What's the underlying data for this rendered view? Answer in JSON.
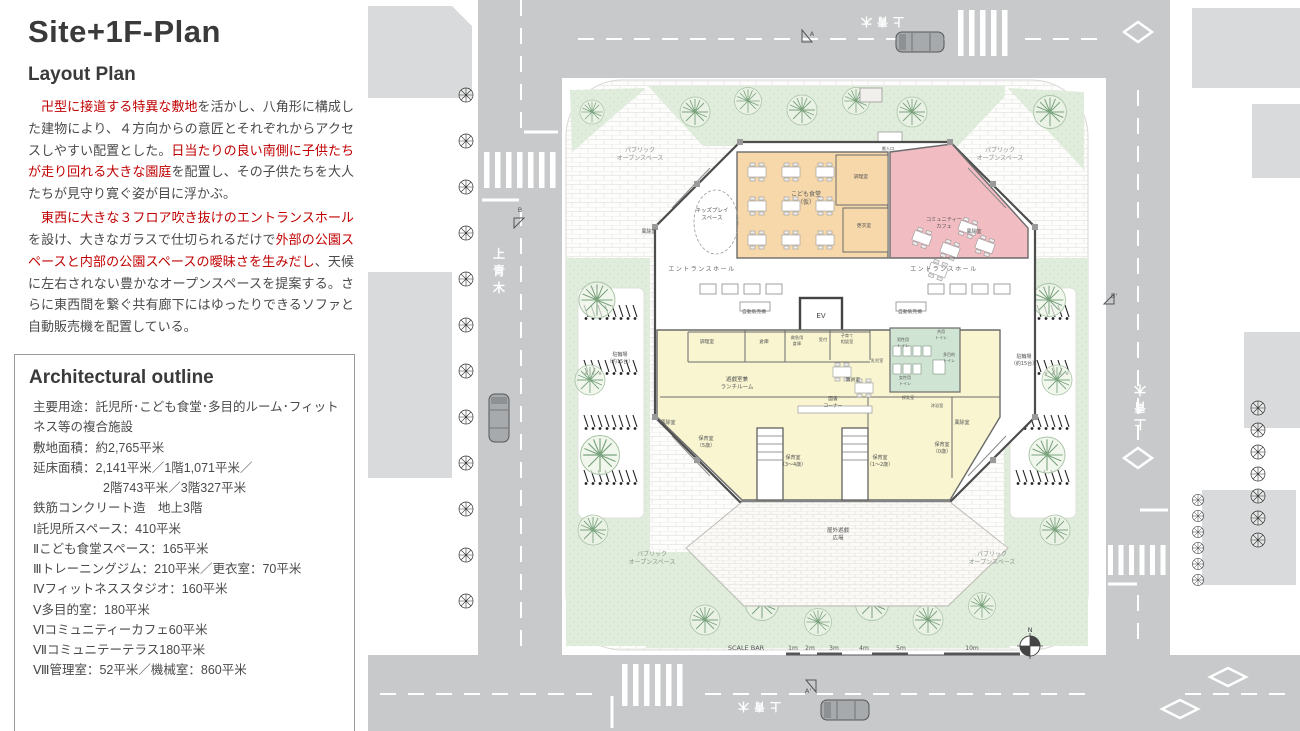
{
  "left_panel": {
    "title": "Site+1F-Plan",
    "subtitle": "Layout Plan",
    "paragraphs": [
      {
        "segments": [
          {
            "text": "　卍型に接道する特異な敷地",
            "red": true
          },
          {
            "text": "を活かし、八角形に構成した建物により、４方向からの意匠とそれぞれからアクセスしやすい配置とした。",
            "red": false
          },
          {
            "text": "日当たりの良い南側に子供たちが走り回れる大きな園庭",
            "red": true
          },
          {
            "text": "を配置し、その子供たちを大人たちが見守り寛ぐ姿が目に浮かぶ。",
            "red": false
          }
        ]
      },
      {
        "segments": [
          {
            "text": "　東西に大きな３フロア吹き抜けのエントランスホール",
            "red": true
          },
          {
            "text": "を設け、大きなガラスで仕切られるだけで",
            "red": false
          },
          {
            "text": "外部の公園スペースと内部の公園スペースの曖昧さを生みだし",
            "red": true
          },
          {
            "text": "、天候に左右されない豊かなオープンスペースを提案する。さらに東西間を繋ぐ共有廊下にはゆったりできるソファと自動販売機を配置している。",
            "red": false
          }
        ]
      }
    ],
    "outline": {
      "title": "Architectural outline",
      "lines": [
        {
          "text": "主要用途：託児所･こども食堂･多目的ルーム･フィットネス等の複合施設",
          "indent": false
        },
        {
          "text": "敷地面積：約2,765平米",
          "indent": false
        },
        {
          "text": "延床面積：2,141平米／1階1,071平米／",
          "indent": false
        },
        {
          "text": "2階743平米／3階327平米",
          "indent": true
        },
        {
          "text": "鉄筋コンクリート造　地上3階",
          "indent": false
        },
        {
          "text": "Ⅰ託児所スペース：410平米",
          "indent": false
        },
        {
          "text": "Ⅱこども食堂スペース：165平米",
          "indent": false
        },
        {
          "text": "Ⅲトレーニングジム：210平米／更衣室：70平米",
          "indent": false
        },
        {
          "text": "Ⅳフィットネススタジオ：160平米",
          "indent": false
        },
        {
          "text": "Ⅴ多目的室：180平米",
          "indent": false
        },
        {
          "text": "Ⅵコミュニティーカフェ60平米",
          "indent": false
        },
        {
          "text": "Ⅶコミュニテーテラス180平米",
          "indent": false
        },
        {
          "text": "Ⅷ管理室：52平米／機械室：860平米",
          "indent": false
        }
      ]
    }
  },
  "plan": {
    "colors": {
      "accent_red": "#c00000",
      "body_text": "#4a4a4a",
      "road_gray": "#c7c9ca",
      "parcel_gray": "#d8dadb",
      "planting_green": "#dfecdc",
      "cafeteria_orange": "#f6d8ab",
      "cafe_pink": "#f1bcc2",
      "nursery_yellow": "#f8f5d0",
      "sanitary_green": "#cfe4d3",
      "wall": "#4d4d4d"
    },
    "labels": [
      {
        "name": "label-public-open-space-nw",
        "lines": [
          "パブリック",
          "オープンスペース"
        ],
        "x": 640,
        "y": 152,
        "s": 6,
        "c": "#8b958b"
      },
      {
        "name": "label-public-open-space-ne",
        "lines": [
          "パブリック",
          "オープンスペース"
        ],
        "x": 1000,
        "y": 152,
        "s": 6,
        "c": "#8b958b"
      },
      {
        "name": "label-public-open-space-sw",
        "lines": [
          "パブリック",
          "オープンスペース"
        ],
        "x": 652,
        "y": 556,
        "s": 6,
        "c": "#8b958b"
      },
      {
        "name": "label-public-open-space-se",
        "lines": [
          "パブリック",
          "オープンスペース"
        ],
        "x": 992,
        "y": 556,
        "s": 6,
        "c": "#8b958b"
      },
      {
        "name": "label-entrance-hall-west",
        "text": "エントランスホール",
        "x": 702,
        "y": 271,
        "s": 6,
        "c": "#666",
        "ls": 1.5
      },
      {
        "name": "label-entrance-hall-east",
        "text": "エントランスホール",
        "x": 944,
        "y": 271,
        "s": 6,
        "c": "#666",
        "ls": 1.5
      },
      {
        "name": "label-kids-play-space",
        "lines": [
          "キッズプレイ",
          "スペース"
        ],
        "x": 712,
        "y": 212,
        "s": 5.5,
        "c": "#555"
      },
      {
        "name": "label-windbreak-room-nw",
        "text": "風除室",
        "x": 649,
        "y": 233,
        "s": 5,
        "c": "#555"
      },
      {
        "name": "label-windbreak-room-ne",
        "text": "風除室",
        "x": 974,
        "y": 233,
        "s": 5,
        "c": "#555"
      },
      {
        "name": "label-windbreak-room-sw",
        "text": "風除室",
        "x": 668,
        "y": 424,
        "s": 5,
        "c": "#555"
      },
      {
        "name": "label-windbreak-room-se",
        "text": "風除室",
        "x": 962,
        "y": 424,
        "s": 5,
        "c": "#555"
      },
      {
        "name": "label-kodomo-shokudo",
        "lines": [
          "こども食堂",
          "（仮）"
        ],
        "x": 806,
        "y": 196,
        "s": 6,
        "c": "#555"
      },
      {
        "name": "label-kitchen-cafeteria",
        "text": "調理室",
        "x": 861,
        "y": 178,
        "s": 4.8,
        "c": "#555"
      },
      {
        "name": "label-changing-room",
        "text": "更衣室",
        "x": 864,
        "y": 227,
        "s": 4.8,
        "c": "#555"
      },
      {
        "name": "label-community-cafe",
        "lines": [
          "コミュニティー",
          "カフェ"
        ],
        "x": 944,
        "y": 221,
        "s": 5.2,
        "c": "#555"
      },
      {
        "name": "label-elevator",
        "text": "EV",
        "x": 821,
        "y": 318,
        "s": 7,
        "c": "#444"
      },
      {
        "name": "label-vending-machine-west",
        "text": "自動販売機",
        "x": 754,
        "y": 313,
        "s": 4.8,
        "c": "#555"
      },
      {
        "name": "label-vending-machine-east",
        "text": "自動販売機",
        "x": 910,
        "y": 313,
        "s": 4.8,
        "c": "#555"
      },
      {
        "name": "label-kitchen",
        "text": "調理室",
        "x": 707,
        "y": 343,
        "s": 4.8,
        "c": "#555"
      },
      {
        "name": "label-storage",
        "text": "倉庫",
        "x": 764,
        "y": 343,
        "s": 4.8,
        "c": "#555"
      },
      {
        "name": "label-first-aid-storage",
        "lines": [
          "救急用",
          "倉庫"
        ],
        "x": 797,
        "y": 339,
        "s": 4.2,
        "c": "#555"
      },
      {
        "name": "label-reception",
        "text": "受付",
        "x": 823,
        "y": 341,
        "s": 4.2,
        "c": "#555"
      },
      {
        "name": "label-childcare-consult-room",
        "lines": [
          "子育て",
          "相談室"
        ],
        "x": 847,
        "y": 337,
        "s": 4.2,
        "c": "#555"
      },
      {
        "name": "label-infant-room",
        "text": "乳児室",
        "x": 877,
        "y": 362,
        "s": 4.2,
        "c": "#555"
      },
      {
        "name": "label-playroom-lunchroom",
        "lines": [
          "遊戯室兼",
          "ランチルーム"
        ],
        "x": 737,
        "y": 381,
        "s": 5.5,
        "c": "#555"
      },
      {
        "name": "label-staff-room",
        "text": "職員室",
        "x": 853,
        "y": 381,
        "s": 4.8,
        "c": "#555"
      },
      {
        "name": "label-book-corner",
        "lines": [
          "図書",
          "コーナー"
        ],
        "x": 833,
        "y": 400,
        "s": 4.8,
        "c": "#555"
      },
      {
        "name": "label-shared-toilet",
        "lines": [
          "共用",
          "トイレ"
        ],
        "x": 941,
        "y": 333,
        "s": 4,
        "c": "#555"
      },
      {
        "name": "label-mens-toilet",
        "lines": [
          "男性用",
          "トイレ"
        ],
        "x": 903,
        "y": 341,
        "s": 4,
        "c": "#555"
      },
      {
        "name": "label-multipurpose-toilet",
        "lines": [
          "多目的",
          "トイレ"
        ],
        "x": 949,
        "y": 356,
        "s": 4,
        "c": "#555"
      },
      {
        "name": "label-womens-toilet",
        "lines": [
          "女性用",
          "トイレ"
        ],
        "x": 905,
        "y": 379,
        "s": 4,
        "c": "#555"
      },
      {
        "name": "label-nursing-room",
        "text": "授乳室",
        "x": 908,
        "y": 399,
        "s": 4.2,
        "c": "#555"
      },
      {
        "name": "label-baby-bath-room",
        "text": "沐浴室",
        "x": 937,
        "y": 407,
        "s": 4.2,
        "c": "#555"
      },
      {
        "name": "label-nursery-room-5",
        "lines": [
          "保育室",
          "（5歳）"
        ],
        "x": 706,
        "y": 440,
        "s": 5,
        "c": "#555"
      },
      {
        "name": "label-nursery-room-3-4",
        "lines": [
          "保育室",
          "（3～4歳）"
        ],
        "x": 793,
        "y": 459,
        "s": 5,
        "c": "#555"
      },
      {
        "name": "label-nursery-room-1-2",
        "lines": [
          "保育室",
          "（1～2歳）"
        ],
        "x": 880,
        "y": 459,
        "s": 5,
        "c": "#555"
      },
      {
        "name": "label-nursery-room-0",
        "lines": [
          "保育室",
          "（0歳）"
        ],
        "x": 942,
        "y": 446,
        "s": 5,
        "c": "#555"
      },
      {
        "name": "label-outdoor-playground",
        "lines": [
          "屋外遊戯",
          "広場"
        ],
        "x": 838,
        "y": 532,
        "s": 5.5,
        "c": "#555"
      },
      {
        "name": "label-bicycle-parking-west",
        "lines": [
          "駐輪場",
          "（約15台）"
        ],
        "x": 620,
        "y": 356,
        "s": 5,
        "c": "#555"
      },
      {
        "name": "label-bicycle-parking-east",
        "lines": [
          "駐輪場",
          "（約15台）"
        ],
        "x": 1024,
        "y": 358,
        "s": 5,
        "c": "#555"
      },
      {
        "name": "label-service-entrance",
        "text": "搬入口",
        "x": 888,
        "y": 150,
        "s": 4.2,
        "c": "#555"
      },
      {
        "name": "label-scale-bar",
        "text": "SCALE BAR",
        "x": 746,
        "y": 650,
        "s": 6.5,
        "c": "#555"
      },
      {
        "name": "scale-tick-1m",
        "text": "1m",
        "x": 793,
        "y": 650,
        "s": 6,
        "c": "#555"
      },
      {
        "name": "scale-tick-2m",
        "text": "2m",
        "x": 810,
        "y": 650,
        "s": 6,
        "c": "#555"
      },
      {
        "name": "scale-tick-3m",
        "text": "3m",
        "x": 834,
        "y": 650,
        "s": 6,
        "c": "#555"
      },
      {
        "name": "scale-tick-4m",
        "text": "4m",
        "x": 864,
        "y": 650,
        "s": 6,
        "c": "#555"
      },
      {
        "name": "scale-tick-5m",
        "text": "5m",
        "x": 901,
        "y": 650,
        "s": 6,
        "c": "#555"
      },
      {
        "name": "scale-tick-10m",
        "text": "10m",
        "x": 972,
        "y": 650,
        "s": 6,
        "c": "#555"
      },
      {
        "name": "label-north",
        "text": "N",
        "x": 1030,
        "y": 632,
        "s": 6.5,
        "c": "#444"
      },
      {
        "name": "label-section-a",
        "text": "A",
        "x": 812,
        "y": 36,
        "s": 6.5,
        "c": "#555"
      },
      {
        "name": "label-section-a-prime",
        "text": "A'",
        "x": 808,
        "y": 693,
        "s": 6.5,
        "c": "#555"
      },
      {
        "name": "label-section-b",
        "text": "B",
        "x": 520,
        "y": 212,
        "s": 6.5,
        "c": "#555"
      },
      {
        "name": "label-section-b-prime",
        "text": "B'",
        "x": 1114,
        "y": 298,
        "s": 6.5,
        "c": "#555"
      },
      {
        "name": "road-name-west",
        "lines": [
          "上",
          "青",
          "木"
        ],
        "x": 499,
        "y": 258,
        "s": 12,
        "c": "#fff",
        "lh": 17,
        "b": 1
      },
      {
        "name": "road-name-east",
        "lines": [
          "上",
          "青",
          "木"
        ],
        "x": 1140,
        "y": 420,
        "s": 12,
        "c": "#fff",
        "lh": 17,
        "b": 1,
        "rot": 180
      },
      {
        "name": "road-name-north",
        "text": "上青木",
        "x": 880,
        "y": 18,
        "s": 11,
        "c": "#fff",
        "ls": 5,
        "b": 1,
        "rot": 180
      },
      {
        "name": "road-name-south",
        "text": "上青木",
        "x": 757,
        "y": 703,
        "s": 11,
        "c": "#fff",
        "ls": 5,
        "b": 1,
        "rot": 180
      }
    ]
  }
}
